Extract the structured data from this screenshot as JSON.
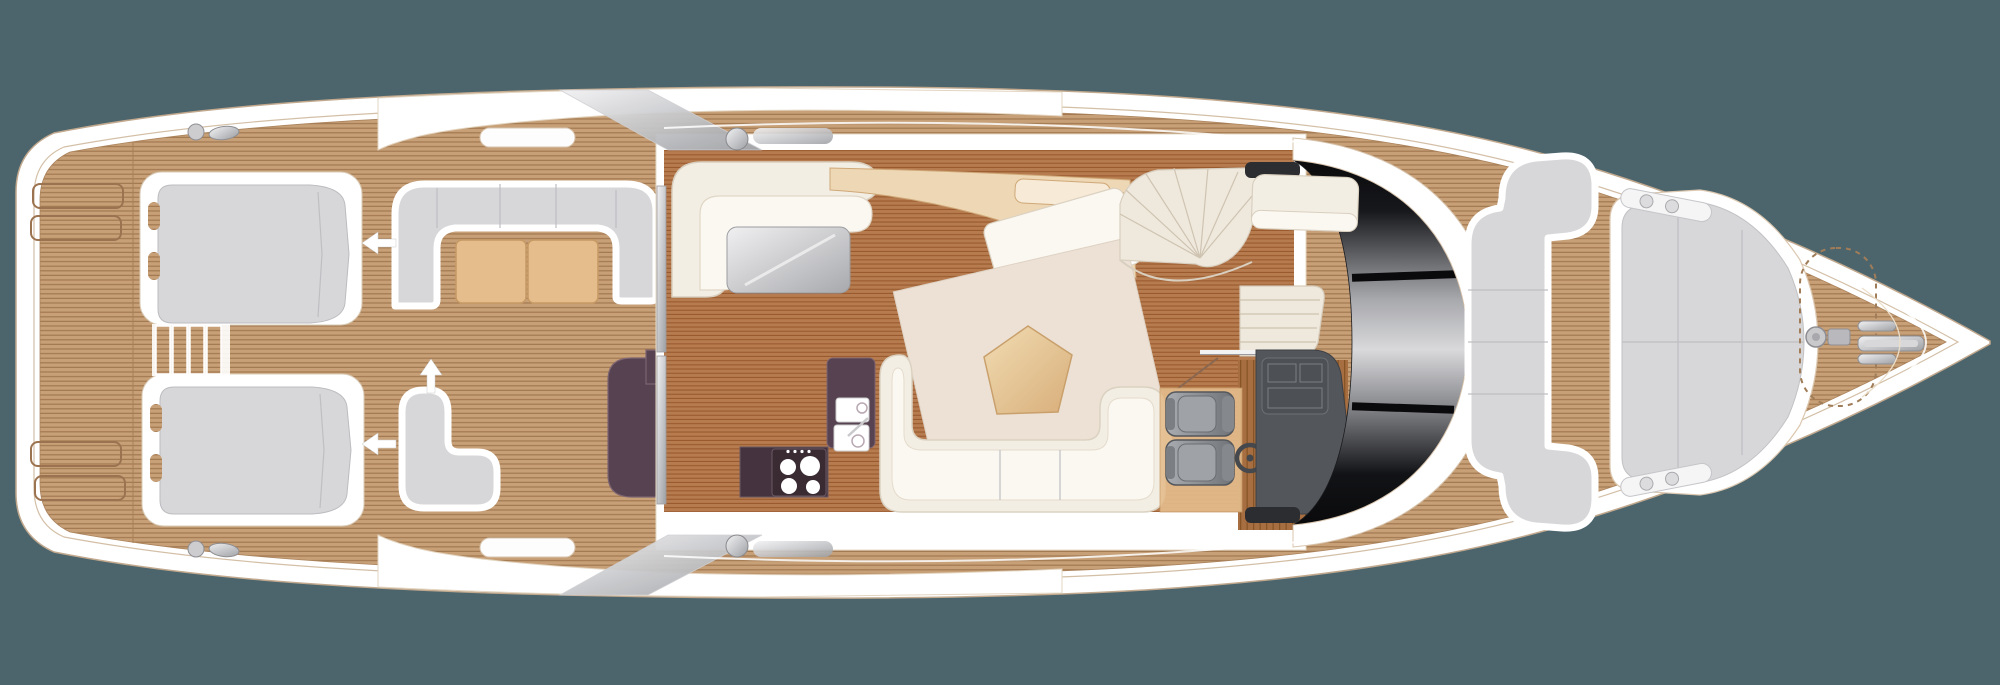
{
  "meta": {
    "view": "yacht-main-deck-floor-plan",
    "orientation": "bow-right",
    "visible_text": "none"
  },
  "canvas": {
    "width": 2000,
    "height": 685
  },
  "colors": {
    "background": "#4c656d",
    "hull_white": "#ffffff",
    "hull_outline": "#c2a98e",
    "teak_base": "#c7a078",
    "teak_stripe": "#a27950",
    "teak_dark_base": "#b67c4f",
    "teak_dark_stripe": "#99592d",
    "plank_base": "#a76f41",
    "plank_stripe": "#875426",
    "slab_white": "#ffffff",
    "cushion_gray": "#d7d7d9",
    "cushion_gray_edge": "#bcbcc0",
    "cream_sofa": "#f3eee4",
    "cream_seat": "#fbf8f1",
    "cream_edge": "#d9cfbf",
    "tan_wood": "#e5bd8d",
    "tan_wood_edge": "#c79a64",
    "tan_light": "#eed7b4",
    "rug_cream": "#ece1d4",
    "aubergine": "#564250",
    "aubergine_dark": "#453440",
    "silver_light": "#f2f2f4",
    "silver_dark": "#9ea0a4",
    "table_silver_light": "#f0f0f1",
    "table_silver_dark": "#a8a9ad",
    "windshield_black": "#0a0a0c",
    "windshield_silver": "#d9d9db",
    "seat_gray_light": "#a9acb1",
    "seat_gray_dark": "#6f7277",
    "console_gray": "#53565b",
    "stair_cream": "#efe9dd",
    "arrow_white": "#ffffff",
    "pentagon_light": "#f1dcb2",
    "pentagon_dark": "#d8ae7a",
    "stove_black": "#3a2b33",
    "white": "#ffffff"
  },
  "arrows": [
    {
      "id": "transom-seat-upper-arrow",
      "direction": "left"
    },
    {
      "id": "transom-seat-lower-arrow",
      "direction": "left"
    },
    {
      "id": "cockpit-sofa-arrow",
      "direction": "up"
    }
  ],
  "features": [
    {
      "id": "swim-platform",
      "kind": "teak-deck"
    },
    {
      "id": "deck-hatches",
      "kind": "recessed-hatches",
      "count": 4
    },
    {
      "id": "transom-seat-upper",
      "kind": "sliding-seat"
    },
    {
      "id": "transom-seat-lower",
      "kind": "sliding-seat"
    },
    {
      "id": "transom-steps",
      "kind": "steps"
    },
    {
      "id": "cockpit-u-sofa",
      "kind": "sofa"
    },
    {
      "id": "cockpit-tables",
      "kind": "table",
      "count": 2
    },
    {
      "id": "cockpit-l-sofa",
      "kind": "sofa"
    },
    {
      "id": "wet-bar",
      "kind": "counter"
    },
    {
      "id": "sliding-door",
      "kind": "door-track"
    },
    {
      "id": "salon-l-sofa",
      "kind": "sofa"
    },
    {
      "id": "salon-coffee-table",
      "kind": "hi-lo-table"
    },
    {
      "id": "sideboard",
      "kind": "cabinet"
    },
    {
      "id": "chaise-lounge",
      "kind": "sofa"
    },
    {
      "id": "dining-rug",
      "kind": "rug"
    },
    {
      "id": "dining-table",
      "kind": "pentagon-table"
    },
    {
      "id": "corner-sofa",
      "kind": "sofa"
    },
    {
      "id": "galley-cabinet",
      "kind": "cabinet"
    },
    {
      "id": "galley-stove",
      "kind": "cooktop",
      "burners": 4
    },
    {
      "id": "galley-sink",
      "kind": "sink"
    },
    {
      "id": "spiral-staircase",
      "kind": "stairs-up"
    },
    {
      "id": "companionway-stairs",
      "kind": "stairs-down"
    },
    {
      "id": "companion-bench",
      "kind": "seat"
    },
    {
      "id": "helm-seats",
      "kind": "seat",
      "count": 2
    },
    {
      "id": "helm-console",
      "kind": "console"
    },
    {
      "id": "steering-wheel",
      "kind": "wheel"
    },
    {
      "id": "windshield",
      "kind": "glass"
    },
    {
      "id": "foredeck-c-sofa",
      "kind": "sofa"
    },
    {
      "id": "bow-sunpad",
      "kind": "lounger"
    },
    {
      "id": "anchor-locker",
      "kind": "dashed-hatch"
    },
    {
      "id": "windlass",
      "kind": "hardware"
    },
    {
      "id": "bow-cleats",
      "kind": "hardware",
      "count": 3
    },
    {
      "id": "radar-arch",
      "kind": "structure"
    }
  ]
}
